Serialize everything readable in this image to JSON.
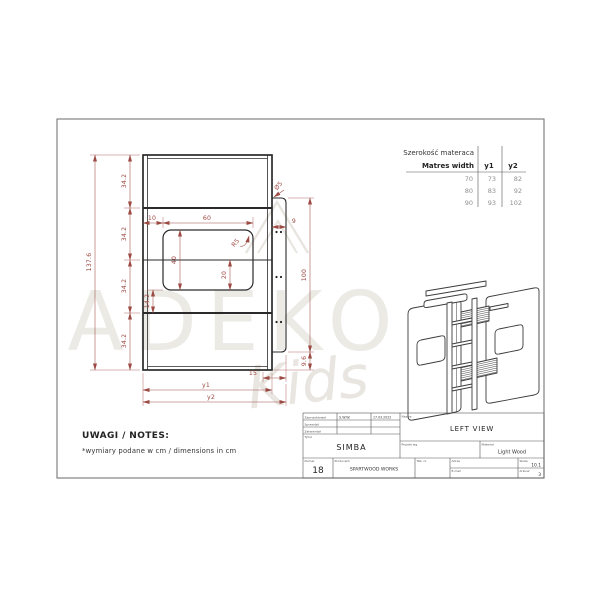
{
  "mattress_table": {
    "title_pl": "Szerokość materaca",
    "title_en": "Matres width",
    "col1": "y1",
    "col2": "y2",
    "rows": [
      {
        "w": "70",
        "y1": "73",
        "y2": "82"
      },
      {
        "w": "80",
        "y1": "83",
        "y2": "92"
      },
      {
        "w": "90",
        "y1": "93",
        "y2": "102"
      }
    ]
  },
  "dims": {
    "total_h": "137.6",
    "seg": "34.2",
    "off": "10",
    "win_w": "60",
    "win_h": "40",
    "win_low": "20",
    "below_win": "14.2",
    "radius": "R5",
    "hole": "Ø5",
    "flange_w": "9",
    "flange_h": "100",
    "flange_b": "9.6",
    "inset": "15",
    "y1": "y1",
    "y2": "y2"
  },
  "notes": {
    "heading": "UWAGI / NOTES:",
    "body": "*wymiary podane w cm / dimensions in cm"
  },
  "watermark": {
    "word": "ADEKO",
    "script": "Kids"
  },
  "title_block": {
    "rows": [
      {
        "label": "Zaprojektował",
        "value": "S.W.W.",
        "date": "17.03.2022"
      },
      {
        "label": "Sprawdził",
        "value": "",
        "date": ""
      },
      {
        "label": "Zatwierdził",
        "value": "",
        "date": ""
      }
    ],
    "title_label": "Tytuł",
    "title": "SIMBA",
    "view_label": "Nazwa",
    "view": "LEFT VIEW",
    "project_label": "Projekt wg",
    "material_label": "Materiał",
    "material": "Light Wood",
    "number_label": "Numer",
    "number": "18",
    "maker_label": "Producent",
    "maker": "SPARTWOOD WORKS",
    "tab_label": "Tab. nr",
    "web_label": "Adres",
    "email_label": "E-mail",
    "scale_label": "Skala",
    "scale": "10.1",
    "sheet_label": "Arkusz",
    "sheet": "3"
  }
}
